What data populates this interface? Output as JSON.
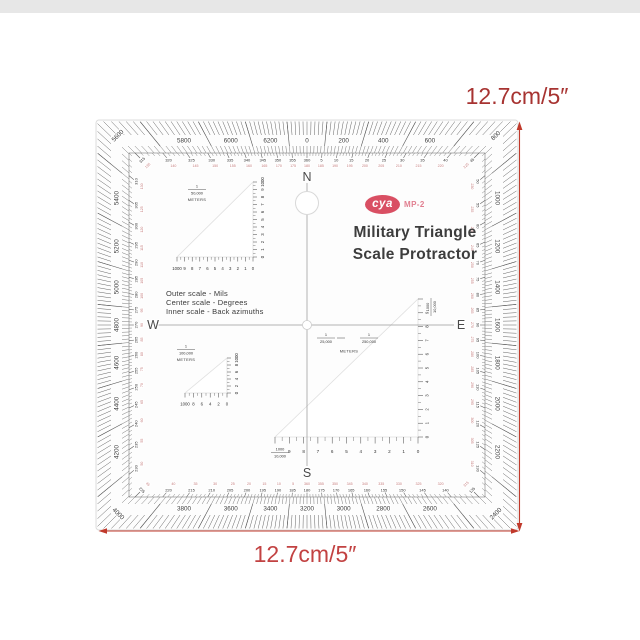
{
  "page": {
    "background": "#ffffff",
    "top_strip_color": "#e7e7e7"
  },
  "annotations": {
    "side_dimension_label": "12.7cm/5″",
    "bottom_dimension_label": "12.7cm/5″",
    "dimension_color": "#c0392b"
  },
  "protractor": {
    "brand": {
      "logo_text": "cya",
      "model": "MP-2",
      "logo_color": "#d94f63"
    },
    "title": {
      "line1": "Military Triangle",
      "line2": "Scale Protractor"
    },
    "legend": {
      "line1": "Outer scale - Mils",
      "line2": "Center scale - Degrees",
      "line3": "Inner scale - Back azimuths"
    },
    "cardinals": {
      "north": "N",
      "east": "E",
      "south": "S",
      "west": "W"
    },
    "outer_mils_labels": [
      0,
      200,
      400,
      600,
      800,
      1000,
      1200,
      1400,
      1600,
      1800,
      2000,
      2200,
      2400,
      2600,
      2800,
      3000,
      3200,
      3400,
      3600,
      3800,
      4000,
      4200,
      4400,
      4600,
      4800,
      5000,
      5200,
      5400,
      5600,
      5800,
      6000,
      6200
    ],
    "degree_ring": [
      [
        5,
        185
      ],
      [
        10,
        190
      ],
      [
        15,
        195
      ],
      [
        20,
        200
      ],
      [
        25,
        205
      ],
      [
        30,
        210
      ],
      [
        35,
        215
      ],
      [
        40,
        220
      ],
      [
        45,
        225
      ],
      [
        50,
        230
      ],
      [
        55,
        235
      ],
      [
        60,
        240
      ],
      [
        65,
        245
      ],
      [
        70,
        250
      ],
      [
        75,
        255
      ],
      [
        80,
        260
      ],
      [
        85,
        265
      ],
      [
        90,
        270
      ],
      [
        95,
        275
      ],
      [
        100,
        280
      ],
      [
        105,
        285
      ],
      [
        110,
        290
      ],
      [
        115,
        295
      ],
      [
        120,
        300
      ],
      [
        125,
        305
      ],
      [
        130,
        310
      ],
      [
        135,
        315
      ],
      [
        140,
        320
      ],
      [
        145,
        325
      ],
      [
        150,
        330
      ],
      [
        155,
        335
      ],
      [
        160,
        340
      ],
      [
        165,
        345
      ],
      [
        170,
        350
      ],
      [
        175,
        355
      ],
      [
        180,
        360
      ],
      [
        185,
        5
      ],
      [
        190,
        10
      ],
      [
        195,
        15
      ],
      [
        200,
        20
      ],
      [
        205,
        25
      ],
      [
        210,
        30
      ],
      [
        215,
        35
      ],
      [
        220,
        40
      ],
      [
        225,
        45
      ],
      [
        230,
        50
      ],
      [
        235,
        55
      ],
      [
        240,
        60
      ],
      [
        245,
        65
      ],
      [
        250,
        70
      ],
      [
        255,
        75
      ],
      [
        260,
        80
      ],
      [
        265,
        85
      ],
      [
        270,
        90
      ],
      [
        275,
        95
      ],
      [
        280,
        100
      ],
      [
        285,
        105
      ],
      [
        290,
        110
      ],
      [
        295,
        115
      ],
      [
        300,
        120
      ],
      [
        305,
        125
      ],
      [
        310,
        130
      ],
      [
        315,
        135
      ],
      [
        320,
        140
      ],
      [
        325,
        145
      ],
      [
        330,
        150
      ],
      [
        335,
        155
      ],
      [
        340,
        160
      ],
      [
        345,
        165
      ],
      [
        350,
        170
      ],
      [
        355,
        175
      ],
      [
        360,
        180
      ]
    ],
    "triangle_scales": [
      {
        "id": "scale-1-50000",
        "ratio_numerator": "1",
        "ratio_denominator": "50,000",
        "unit": "METERS",
        "edge_labels": [
          "1000",
          "9",
          "8",
          "7",
          "6",
          "5",
          "4",
          "3",
          "2",
          "1",
          "0"
        ],
        "side_labels": [
          "0",
          "1",
          "2",
          "3",
          "4",
          "5",
          "6",
          "7",
          "8",
          "9",
          "1000"
        ]
      },
      {
        "id": "scale-1-100000",
        "ratio_numerator": "1",
        "ratio_denominator": "100,000",
        "unit": "METERS",
        "edge_labels": [
          "1000",
          "8",
          "6",
          "4",
          "2",
          "0"
        ],
        "side_labels": [
          "0",
          "2",
          "4",
          "6",
          "8",
          "1000"
        ]
      },
      {
        "id": "scale-1000-10000",
        "ratio_numerator": "1000",
        "ratio_denominator": "10,000",
        "unit": "",
        "edge_labels": [
          "9",
          "8",
          "7",
          "6",
          "5",
          "4",
          "3",
          "2",
          "1",
          "0"
        ],
        "side_labels": [
          "0",
          "1",
          "2",
          "3",
          "4",
          "5",
          "6",
          "7",
          "8",
          "9"
        ]
      }
    ],
    "center_scale": {
      "fraction1": {
        "numerator": "1",
        "denominator": "25,000"
      },
      "fraction2": {
        "numerator": "1",
        "denominator": "250,000"
      },
      "unit": "METERS"
    }
  }
}
